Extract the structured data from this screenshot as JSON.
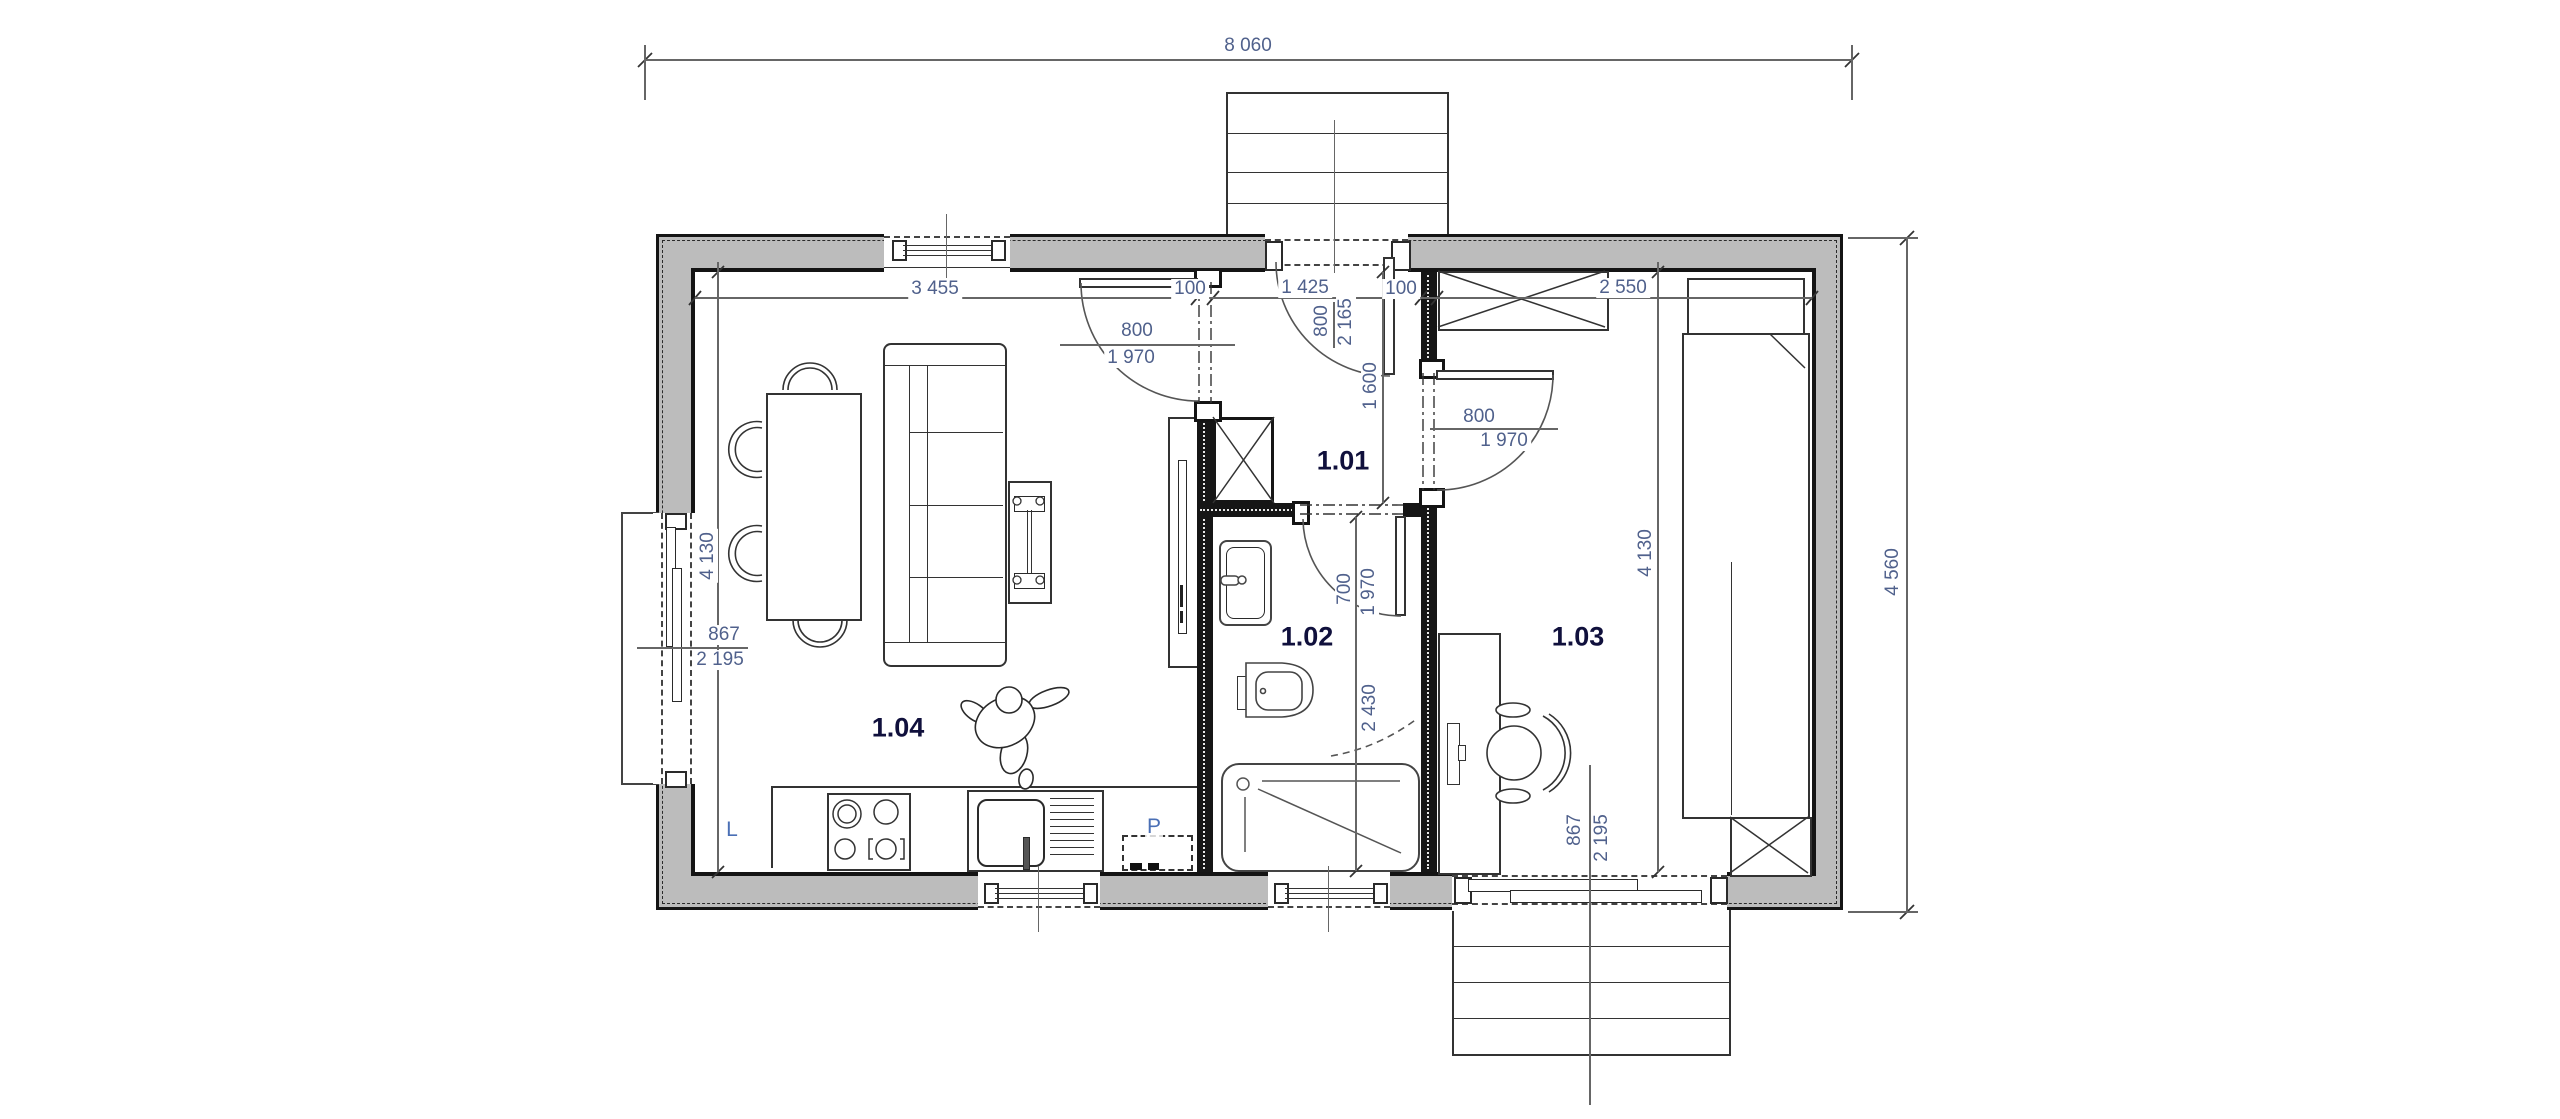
{
  "drawing_title": "floor-plan",
  "dimensions": {
    "overall_width": "8 060",
    "overall_depth": "4 560",
    "living_width": "3 455",
    "partition_left_thickness": "100",
    "hall_width": "1 425",
    "partition_right_thickness": "100",
    "bedroom_width": "2 550",
    "living_depth": "4 130",
    "bedroom_depth": "4 130",
    "hall_length": "1 600",
    "bathroom_length": "2 430"
  },
  "door_labels": {
    "entrance": {
      "w": "800",
      "h": "2 165"
    },
    "living": {
      "w": "800",
      "h": "1 970"
    },
    "bedroom": {
      "w": "800",
      "h": "1 970"
    },
    "bathroom": {
      "w": "700",
      "h": "1 970"
    },
    "left_terrace": {
      "w": "867",
      "h": "2 195"
    },
    "bedroom_terrace": {
      "w": "867",
      "h": "2 195"
    }
  },
  "rooms": {
    "hall": "1.01",
    "bathroom": "1.02",
    "bedroom": "1.03",
    "living": "1.04"
  },
  "appliances": {
    "fridge": "L",
    "washing_machine": "P"
  }
}
